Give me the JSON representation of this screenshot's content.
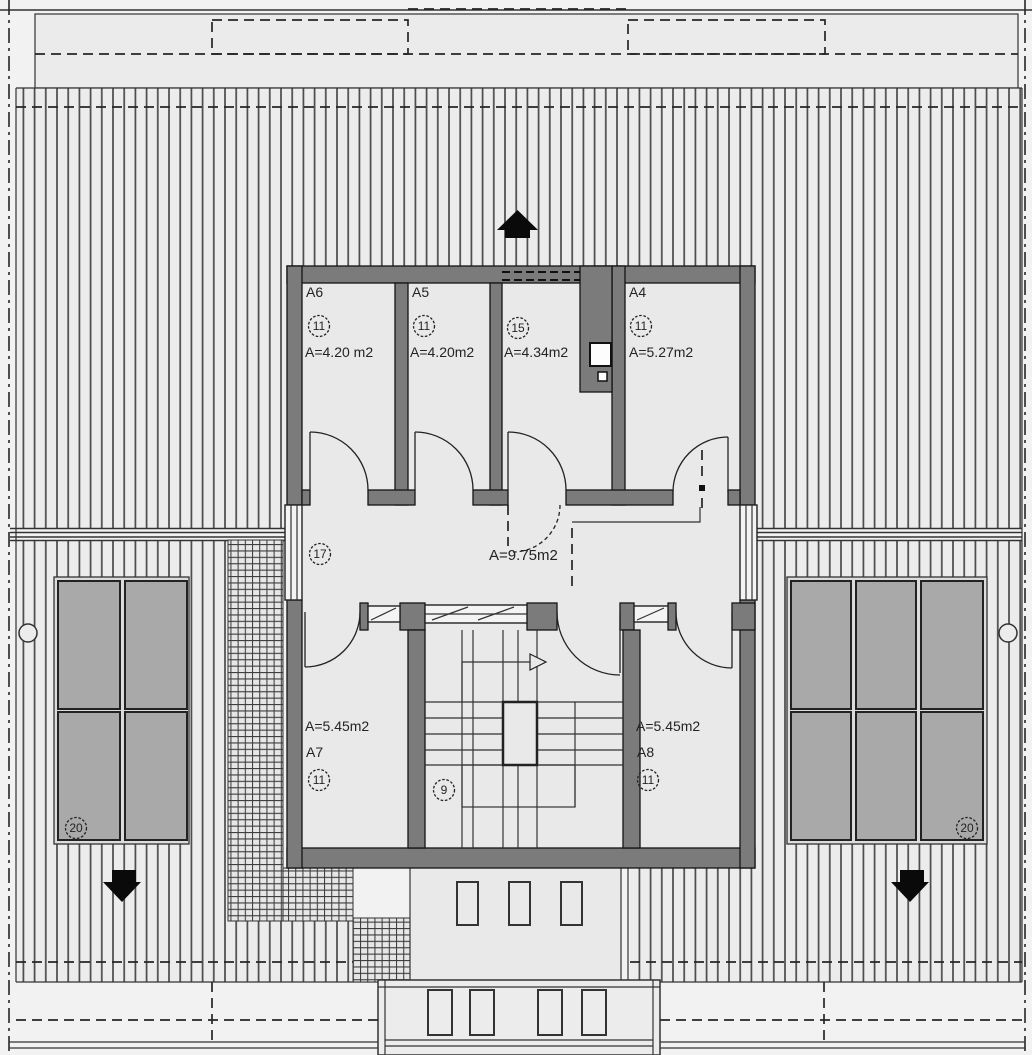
{
  "colors": {
    "wall": "#7b7b7b",
    "floor": "#e9e9e9",
    "panel": "#a9a9a9",
    "roof_line": "#4a4a4a",
    "background": "#f2f2f2"
  },
  "rooms": [
    {
      "name": "A6",
      "tag": "11",
      "area": "A=4.20 m2"
    },
    {
      "name": "A5",
      "tag": "11",
      "area": "A=4.20m2"
    },
    {
      "name": "",
      "tag": "15",
      "area": "A=4.34m2"
    },
    {
      "name": "A4",
      "tag": "11",
      "area": "A=5.27m2"
    },
    {
      "name": "A7",
      "tag": "11",
      "area": "A=5.45m2"
    },
    {
      "name": "A8",
      "tag": "11",
      "area": "A=5.45m2"
    }
  ],
  "hallway": {
    "tag": "17",
    "area": "A=9.75m2"
  },
  "staircase": {
    "tag": "9"
  },
  "solar_arrays": {
    "left_tag": "20",
    "right_tag": "20"
  }
}
